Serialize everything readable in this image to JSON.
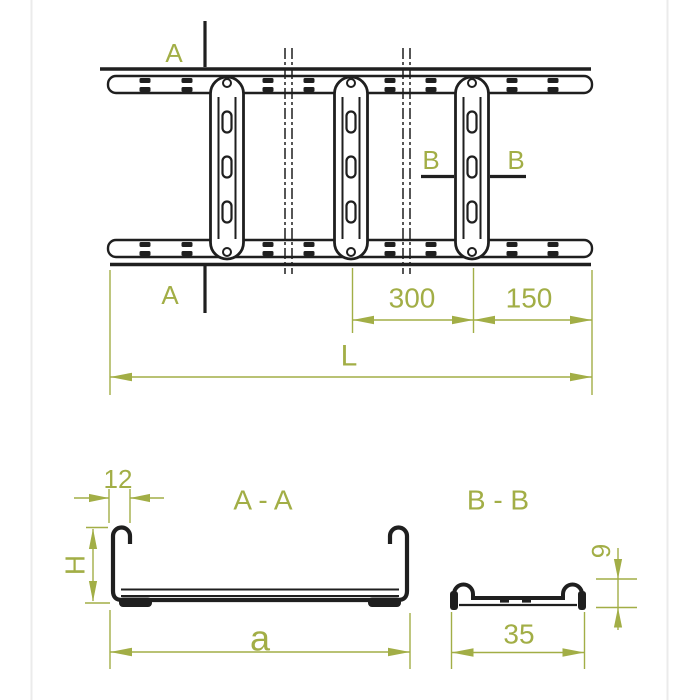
{
  "drawing": {
    "kind": "cable-ladder technical drawing",
    "views": [
      "plan view",
      "section A-A",
      "section B-B"
    ]
  },
  "colors": {
    "line": "#1f1f1f",
    "annotation": "#a2ae46",
    "background": "#ffffff",
    "canvas_edge": "#ebebeb"
  },
  "plan_view": {
    "section_a": {
      "label_top": "A",
      "label_bottom": "A"
    },
    "section_b": {
      "label_left": "B",
      "label_right": "B"
    },
    "dims": {
      "rung_spacing": "300",
      "end_offset": "150",
      "overall_length": "L"
    }
  },
  "section_aa": {
    "title": "A - A",
    "dims": {
      "hook_width": "12",
      "side_height": "H",
      "width": "a"
    }
  },
  "section_bb": {
    "title": "B - B",
    "dims": {
      "height": "9",
      "width": "35"
    }
  }
}
